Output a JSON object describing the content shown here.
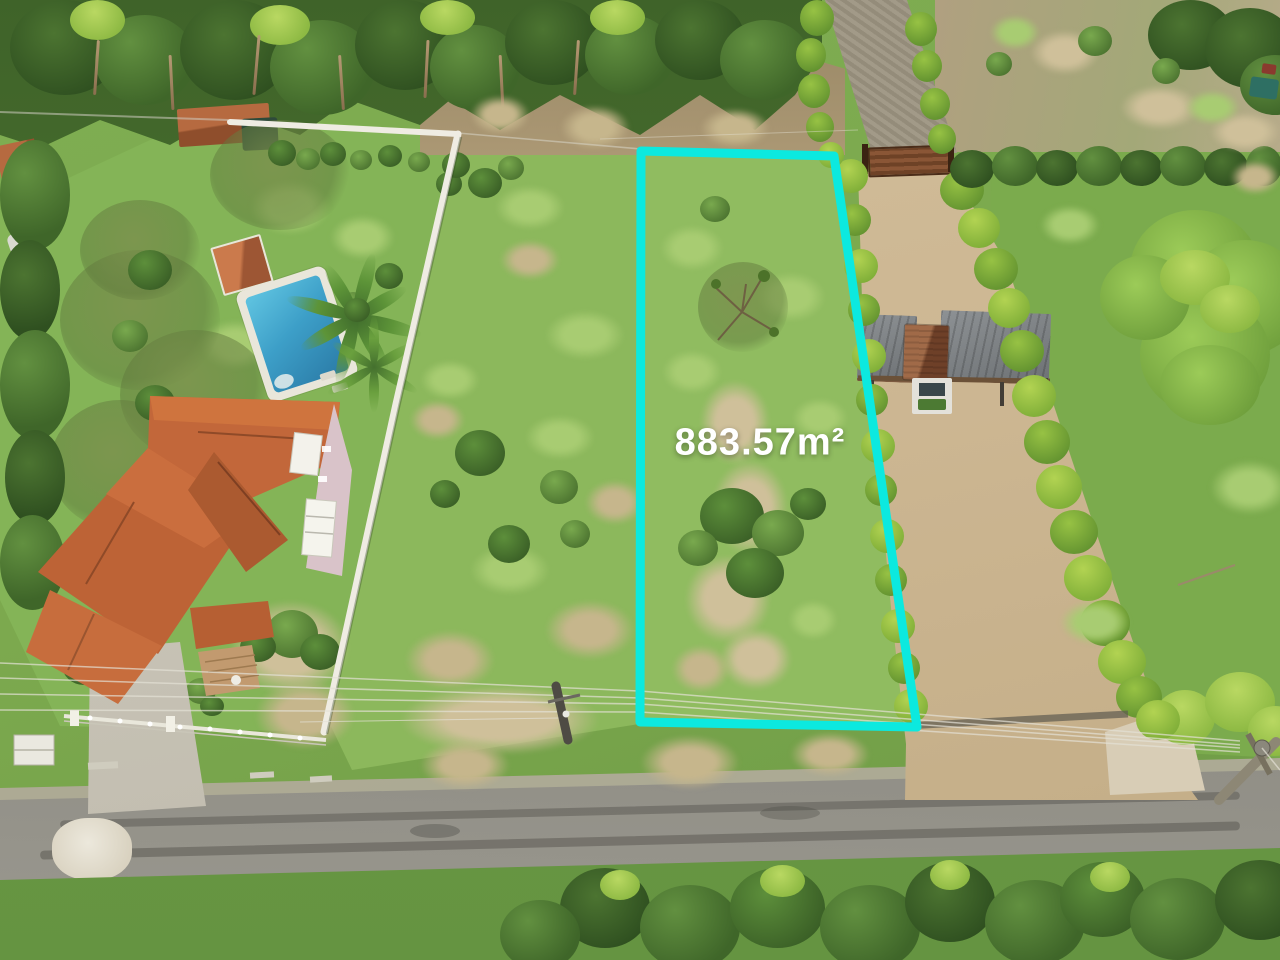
{
  "scene": {
    "type": "aerial-drone-photo",
    "subject": "Vacant land parcel outlined for sale",
    "surroundings": [
      "tree line and neighboring lots (top)",
      "house with tiled roof and swimming pool (left)",
      "open grass field (center)",
      "sand driveway with carports and hedges (right)",
      "asphalt road (bottom)"
    ]
  },
  "overlay": {
    "area_label": "883.57m²",
    "outline_color": "#0CE9DF",
    "label_color": "#FFFFFF"
  },
  "palette": {
    "grass": "#7CA94E",
    "grass_light": "#9DC468",
    "foliage_dark": "#3E6329",
    "hedge_bright": "#8FBE45",
    "sand": "#CDB793",
    "dirt": "#A5926F",
    "road_asphalt": "#87857D",
    "roof_terracotta": "#C2673A",
    "pool_water": "#3D9FC8",
    "wall_white": "#EFECE3",
    "gate_wood": "#8A5636",
    "carport_metal": "#7D8184"
  }
}
